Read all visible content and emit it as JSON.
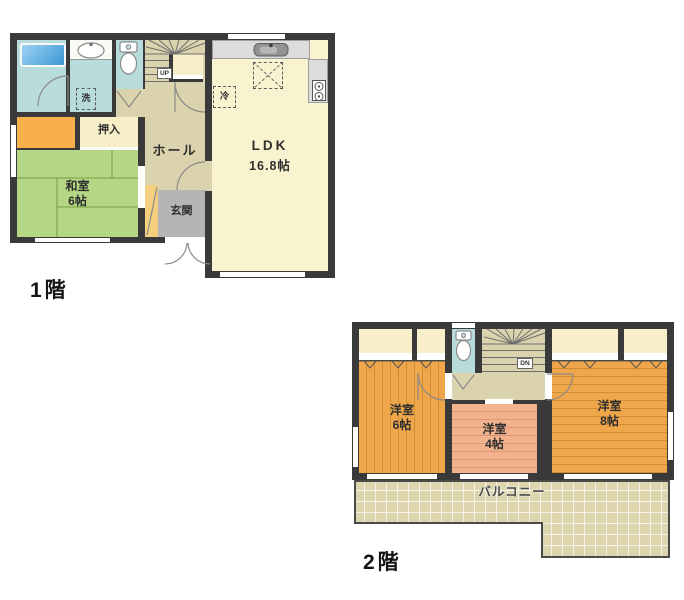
{
  "plan_title": "2-story house floor plan",
  "floor1": {
    "caption": "1階",
    "labels": {
      "washitsu_name": "和室",
      "washitsu_size": "6帖",
      "oshiire": "押入",
      "hall": "ホール",
      "ldk_name": "LDK",
      "ldk_size": "16.8帖",
      "genkan": "玄関",
      "laundry": "洗",
      "fridge": "冷",
      "stairs_dir": "UP"
    }
  },
  "floor2": {
    "caption": "2階",
    "labels": {
      "room6_name": "洋室",
      "room6_size": "6帖",
      "room4_name": "洋室",
      "room4_size": "4帖",
      "room8_name": "洋室",
      "room8_size": "8帖",
      "balcony": "バルコニー",
      "stairs_dir": "DN"
    }
  },
  "colors": {
    "wall": "#3a3a3a",
    "bath_cyan": "#b7dcdb",
    "tub_blue": "#5aaede",
    "hall_beige": "#dbd3ad",
    "ldk_cream": "#faf3cf",
    "closet_cream": "#f8efc8",
    "closet_orange": "#f7b04a",
    "tatami_green": "#b5d785",
    "genkan_gray": "#b5b5b5",
    "counter_gray": "#dcdcdc",
    "wood_orange": "#f0a74c",
    "wood_salmon": "#f2b28e",
    "balcony_beige": "#dcd5ae",
    "shoe_yellow": "#f4cf7e"
  }
}
